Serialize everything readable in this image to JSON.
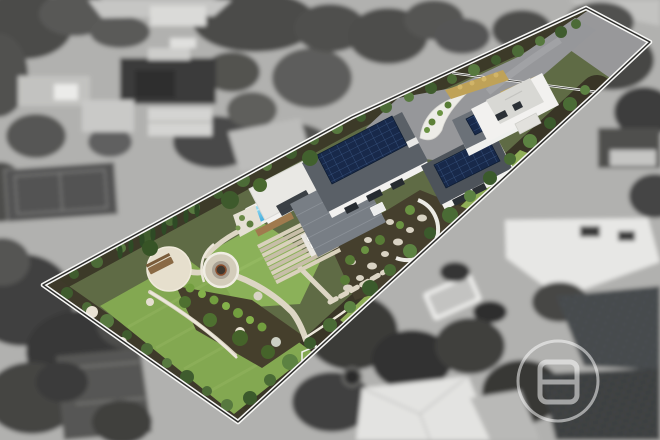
{
  "meta": {
    "kind": "aerial-property-photograph",
    "label": "Aerial photo of a landscaped modern home; surroundings in grayscale, property highlighted in colour with white boundary outline",
    "width": 660,
    "height": 440
  },
  "scene": {
    "surroundings": {
      "style": "grayscale, softly blurred",
      "elements": [
        "neighbouring-houses",
        "tree-canopy",
        "tennis-court",
        "street",
        "neighbour-pool",
        "dark-tiled-roofs",
        "white-hip-roof",
        "round-spa"
      ]
    },
    "property": {
      "highlight": "full-colour",
      "boundary": {
        "style": "double-white-line",
        "line_color": "#f7f7f5",
        "core_color": "#2e2e2c"
      },
      "features": [
        {
          "name": "main-house",
          "desc": "white modern two-storey residence, grey standing-seam roofs"
        },
        {
          "name": "solar-panel-arrays",
          "color": "#18294a"
        },
        {
          "name": "swimming-pool",
          "color": "#55bbe6"
        },
        {
          "name": "guest-house",
          "desc": "white second dwelling near street entrance"
        },
        {
          "name": "driveway-forecourt",
          "color": "#97979a"
        },
        {
          "name": "upper-lawn",
          "color": "#8bb159"
        },
        {
          "name": "lower-lawn",
          "color": "#83a851"
        },
        {
          "name": "fire-pit-circle",
          "desc": "round seat wall with central fire bowl"
        },
        {
          "name": "gravel-courtyard",
          "desc": "cream gravel circle with timber bench"
        },
        {
          "name": "terrace-steps",
          "color": "#d9d1bc"
        },
        {
          "name": "perimeter-hedges",
          "color": "#3f5c2e"
        },
        {
          "name": "pencil-pine-row",
          "color": "#2e4a25"
        },
        {
          "name": "amber-hedge",
          "color": "#bfa258"
        },
        {
          "name": "curved-white-garden-walls",
          "color": "#edece7"
        }
      ]
    },
    "watermark": {
      "shape": "circle outline with rounded-square emblem and centre bar",
      "color": "#ffffff",
      "opacity": 0.52,
      "position": "bottom-right"
    }
  }
}
